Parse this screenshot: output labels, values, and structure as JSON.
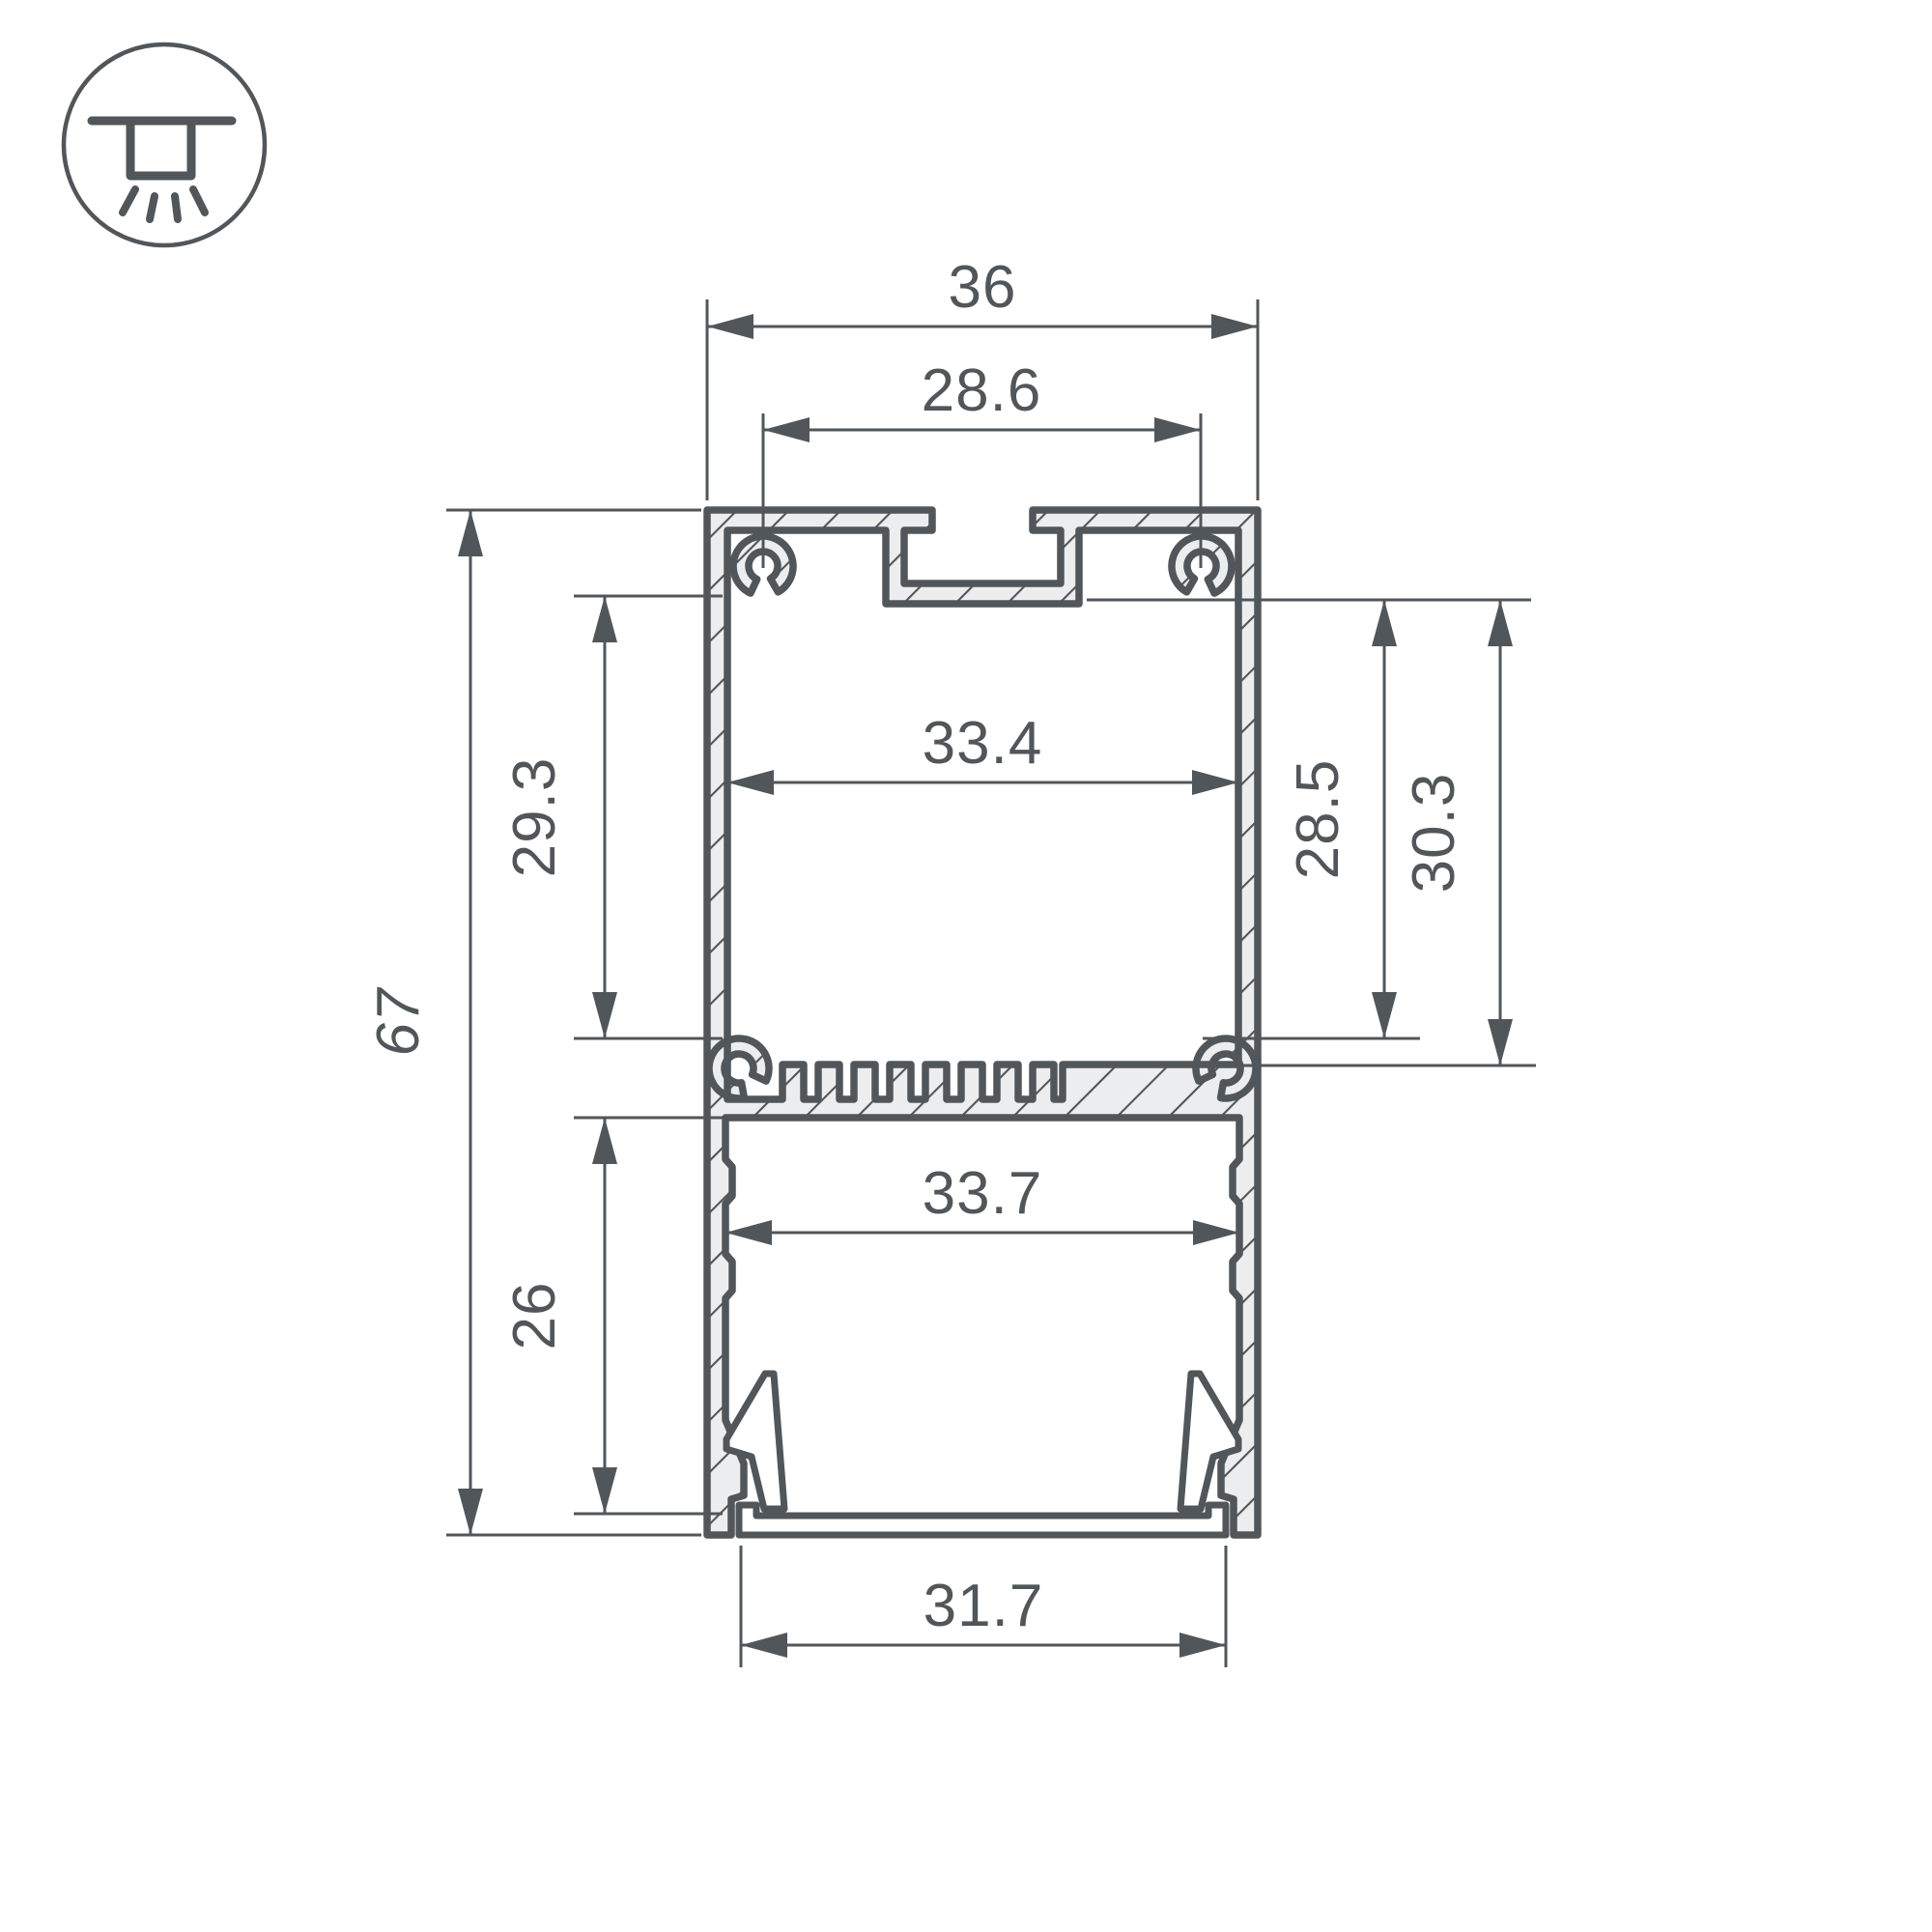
{
  "drawing": {
    "type": "aluminum-led-profile-cross-section",
    "icon": "surface-ceiling-light-icon"
  },
  "dimensions": {
    "outer_width": "36",
    "mount_slot_spacing": "28.6",
    "upper_chamber_width": "33.4",
    "upper_chamber_height": "29.3",
    "total_height": "67",
    "right_inner_height_a": "28.5",
    "right_inner_height_b": "30.3",
    "lower_chamber_width": "33.7",
    "lower_chamber_height": "26",
    "diffuser_width": "31.7"
  },
  "colors": {
    "line": "#51565a",
    "material_fill": "#ecedee",
    "background": "#ffffff"
  }
}
